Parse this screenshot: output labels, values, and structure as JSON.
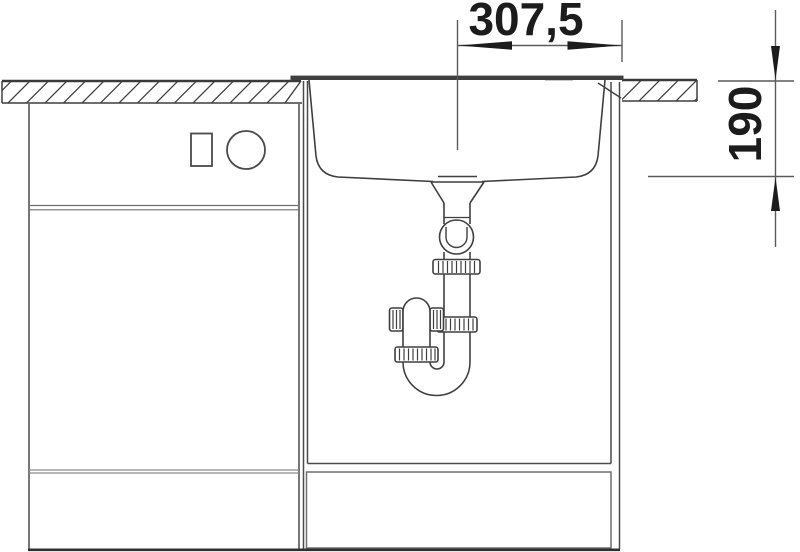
{
  "diagram": {
    "type": "technical-installation-drawing",
    "subject": "inset-sink-cross-section-with-drain-trap",
    "dimensions": {
      "horizontal": {
        "label": "307,5",
        "meaning": "drain-center-to-right-edge"
      },
      "vertical": {
        "label": "190",
        "meaning": "worktop-top-to-bowl-bottom-depth"
      }
    },
    "colors": {
      "outline": "#3f3f3f",
      "dimension_line": "#5a5a5a",
      "dimension_text": "#1c1c1c",
      "soft_gray": "#8a8a8a",
      "background": "#ffffff"
    }
  }
}
